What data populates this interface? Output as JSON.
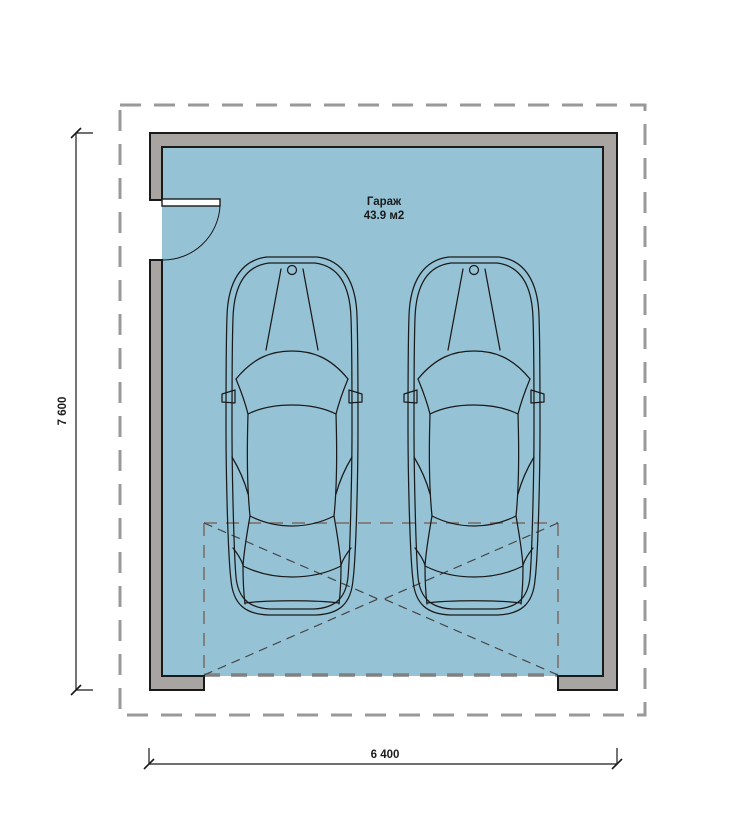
{
  "room": {
    "name": "Гараж",
    "area": "43.9 м2"
  },
  "dimensions": {
    "vertical": "7 600",
    "horizontal": "6 400"
  },
  "colors": {
    "bg": "#ffffff",
    "floor": "#95c3d5",
    "wall": "#a7a4a2",
    "outline": "#1a1a1a",
    "roof_dash": "#999999",
    "door_dash": "#808080",
    "diag_dash": "#444444"
  }
}
